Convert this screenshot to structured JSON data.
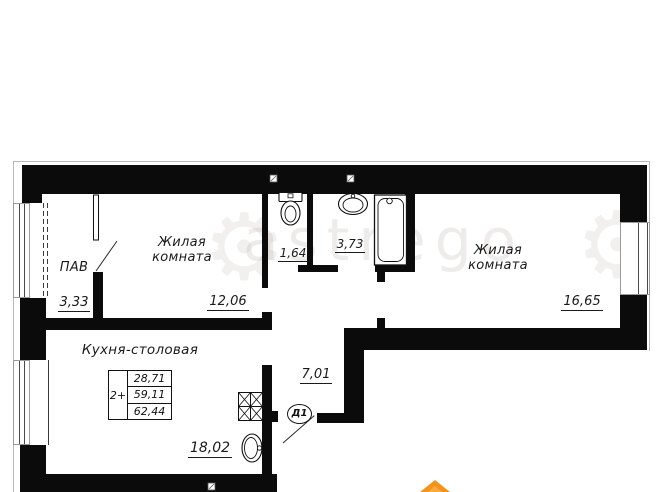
{
  "plan": {
    "watermark": "astrego",
    "rooms": [
      {
        "id": "pav",
        "label": "ПАВ",
        "area": "3,33"
      },
      {
        "id": "room1",
        "label_line1": "Жилая",
        "label_line2": "комната",
        "area": "12,06"
      },
      {
        "id": "wc",
        "area": "1,64"
      },
      {
        "id": "bath",
        "area": "3,73"
      },
      {
        "id": "room2",
        "label_line1": "Жилая",
        "label_line2": "комната",
        "area": "16,65"
      },
      {
        "id": "kitchen",
        "label": "Кухня-столовая",
        "area": "18,02"
      },
      {
        "id": "hall",
        "area": "7,01"
      }
    ],
    "door_label": "Д1",
    "stamp": {
      "rooms_count": "2+",
      "living_area": "28,71",
      "total_area": "59,11",
      "total_with_balcony": "62,44"
    },
    "colors": {
      "wall": "#0b0b0b",
      "outline": "#b9b9b9",
      "accent_orange": "#f2941c"
    }
  }
}
